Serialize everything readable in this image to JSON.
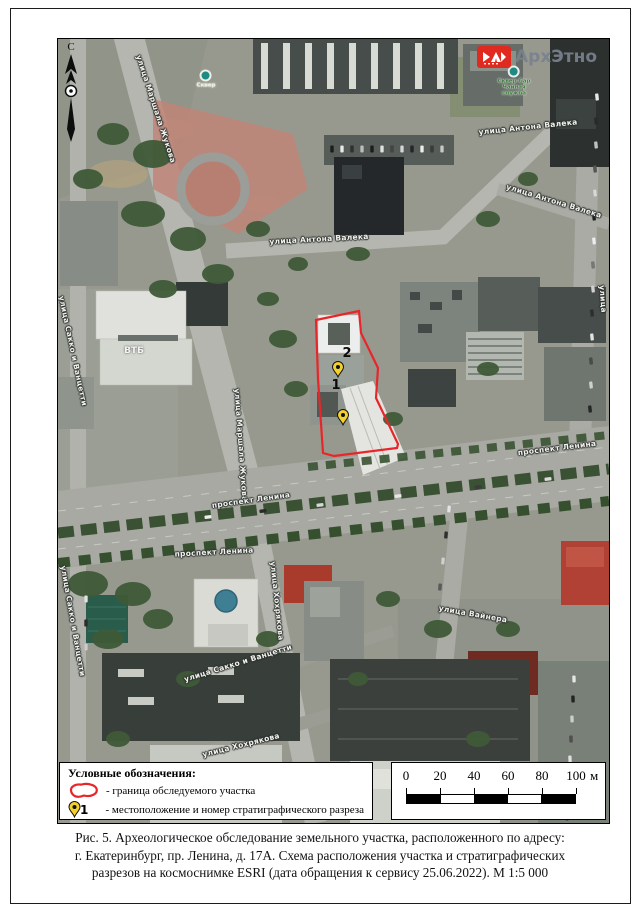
{
  "header": {
    "logo_text": "АрхЭтно",
    "north_label": "С"
  },
  "map": {
    "site_boundary_color": "#e8262a",
    "marker_color": "#f2d12e",
    "street_labels": [
      {
        "text": "улица Маршала Жукова",
        "x": 98,
        "y": 70,
        "rot": 72
      },
      {
        "text": "улица Антона Валека",
        "x": 261,
        "y": 200,
        "rot": -3
      },
      {
        "text": "улица Антона Валека",
        "x": 470,
        "y": 88,
        "rot": -6
      },
      {
        "text": "улица Антона Валека",
        "x": 496,
        "y": 162,
        "rot": 17
      },
      {
        "text": "улица Маршала Жукова",
        "x": 183,
        "y": 406,
        "rot": 86
      },
      {
        "text": "проспект Ленина",
        "x": 193,
        "y": 461,
        "rot": -8
      },
      {
        "text": "проспект Ленина",
        "x": 156,
        "y": 513,
        "rot": -3
      },
      {
        "text": "проспект Ленина",
        "x": 499,
        "y": 409,
        "rot": -7
      },
      {
        "text": "улица Вайнера",
        "x": 415,
        "y": 575,
        "rot": 10
      },
      {
        "text": "улица Сакко и Ванцетти",
        "x": 15,
        "y": 582,
        "rot": 80
      },
      {
        "text": "улица Сакко и Ванцетти",
        "x": 180,
        "y": 624,
        "rot": -17
      },
      {
        "text": "улица Хохрякова",
        "x": 219,
        "y": 562,
        "rot": 84
      },
      {
        "text": "улица Хохрякова",
        "x": 183,
        "y": 706,
        "rot": -14
      },
      {
        "text": "улица Сакко и Ванцетти",
        "x": 15,
        "y": 312,
        "rot": 78
      },
      {
        "text": "улица",
        "x": 545,
        "y": 260,
        "rot": 86
      }
    ],
    "poi_labels": [
      {
        "lines": [
          "Сквер"
        ],
        "x": 148,
        "y": 40,
        "color": "#ecebe2"
      },
      {
        "lines": [
          "Сквер-бар",
          "Чайная",
          "служба"
        ],
        "x": 456,
        "y": 42,
        "color": "#3f7c3f"
      }
    ],
    "building_labels": [
      {
        "text": "ВТБ",
        "x": 76,
        "y": 312
      }
    ],
    "markers": [
      {
        "number": "2",
        "x": 280,
        "y": 344,
        "num_dx": 11,
        "num_dy": -15
      },
      {
        "number": "1",
        "x": 285,
        "y": 392,
        "num_dx": -5,
        "num_dy": -31
      }
    ]
  },
  "legend": {
    "title": "Условные обозначения:",
    "items": [
      {
        "icon": "site-boundary-icon",
        "label": "- граница обследуемого участка"
      },
      {
        "icon": "pin-icon",
        "pin_number": "1",
        "label": "- местоположение и номер стратиграфического разреза"
      }
    ]
  },
  "scalebar": {
    "tick_labels": [
      "0",
      "20",
      "40",
      "60",
      "80",
      "100"
    ],
    "unit": "м",
    "segment_px": 34,
    "pad_px": 14
  },
  "caption": {
    "lines": [
      "Рис. 5. Археологическое обследование земельного участка, расположенного по адресу:",
      "г. Екатеринбург, пр. Ленина, д. 17А. Схема расположения участка и стратиграфических",
      "разрезов на космоснимке ESRI (дата обращения к сервису 25.06.2022). М 1:5 000"
    ]
  }
}
